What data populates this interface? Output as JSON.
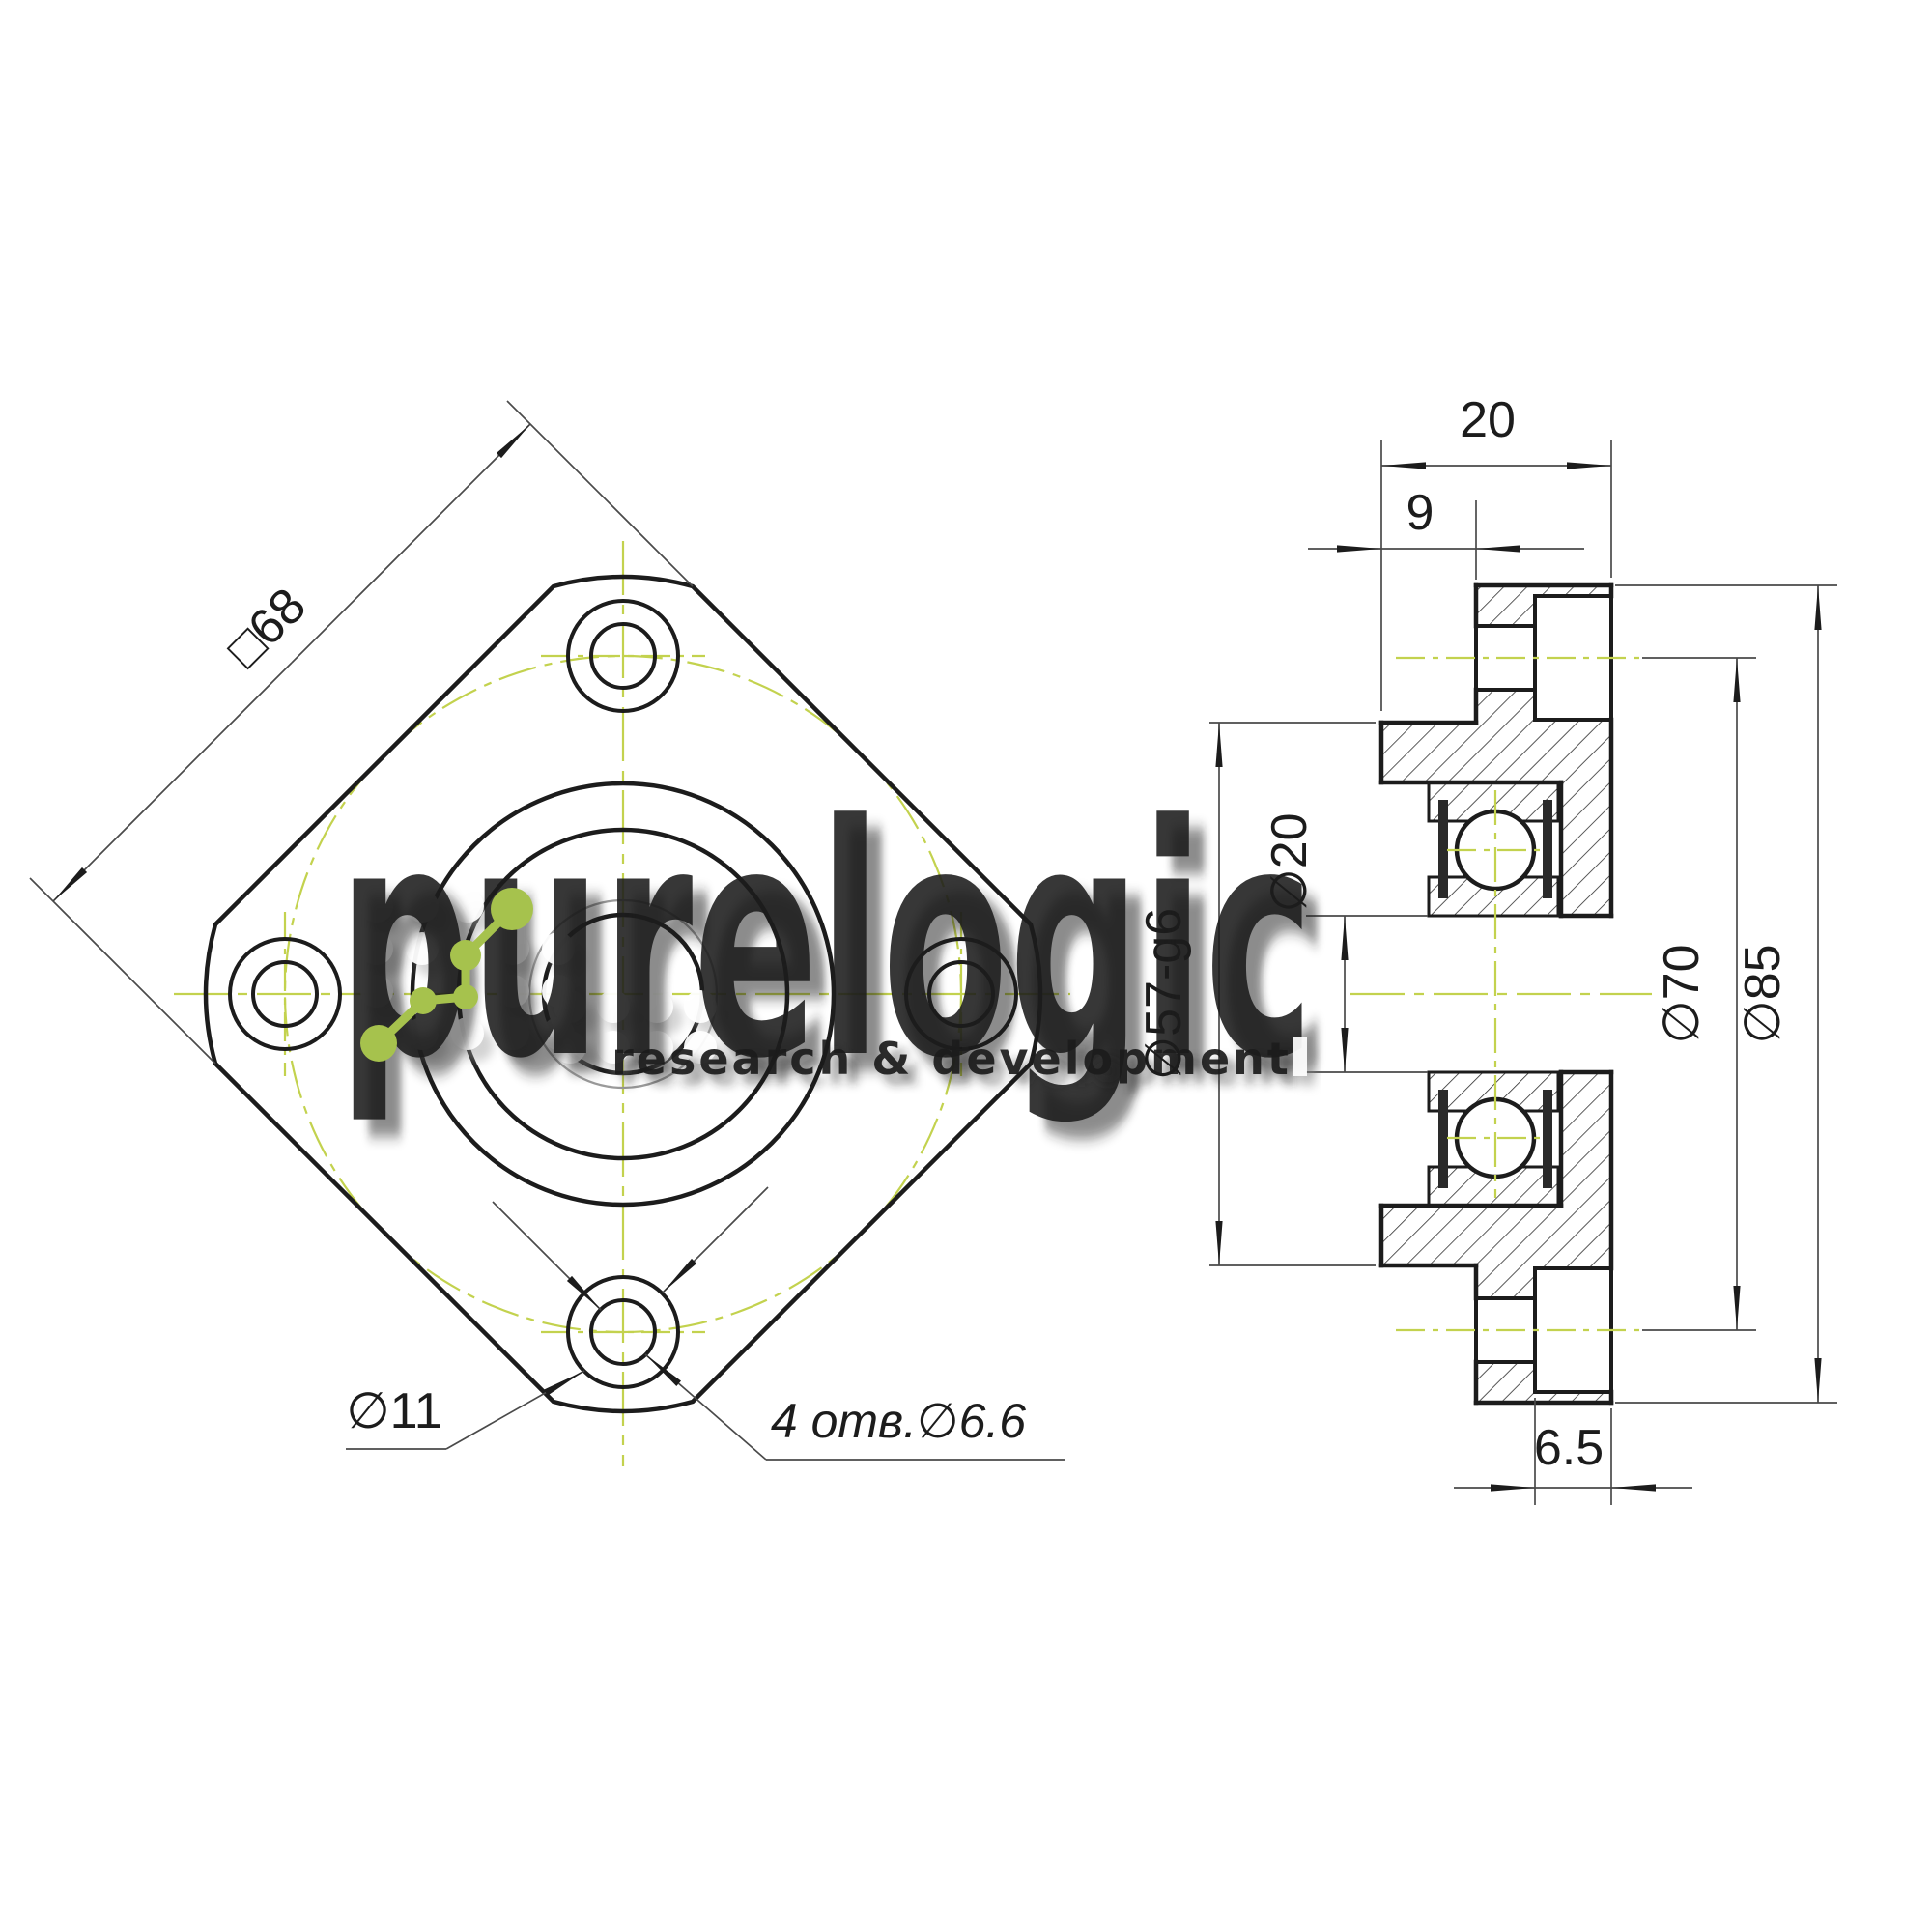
{
  "drawing": {
    "front_view": {
      "square_size_label": "□68",
      "counterbore_label": "∅11",
      "bolt_holes_label": "4 отв.∅6.6"
    },
    "side_view": {
      "overall_width_label": "20",
      "spigot_length_label": "9",
      "bore_label": "∅20",
      "spigot_diameter_label": "∅57-g6",
      "bolt_circle_label": "∅70",
      "flange_diameter_label": "∅85",
      "counterbore_depth_label": "6.5"
    }
  },
  "watermark": {
    "brand": "purelogic",
    "tagline": "research & development"
  },
  "colors": {
    "line": "#1c1c1c",
    "dim_line": "#4a4a4a",
    "centerline_green": "#c3d24e",
    "logo_green": "#a6c24d",
    "watermark_white": "#ffffff",
    "background": "#ffffff"
  }
}
